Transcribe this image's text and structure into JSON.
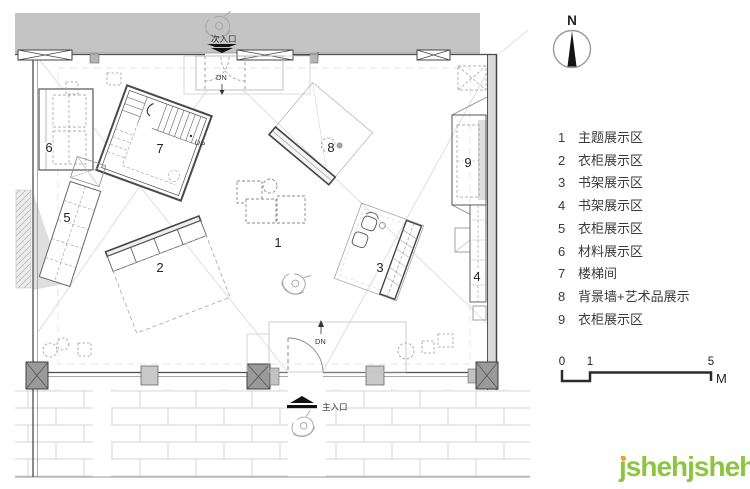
{
  "plan": {
    "zone_numbers": [
      "1",
      "2",
      "3",
      "4",
      "5",
      "6",
      "7",
      "8",
      "9"
    ],
    "labels": {
      "secondary_entrance": "次入口",
      "main_entrance": "主入口",
      "down_top": "DN",
      "down_bottom": "DN",
      "up": "UP"
    }
  },
  "north_arrow": {
    "label": "N"
  },
  "legend": {
    "items": [
      {
        "num": "1",
        "label": "主题展示区"
      },
      {
        "num": "2",
        "label": "衣柜展示区"
      },
      {
        "num": "3",
        "label": "书架展示区"
      },
      {
        "num": "4",
        "label": "书架展示区"
      },
      {
        "num": "5",
        "label": "衣柜展示区"
      },
      {
        "num": "6",
        "label": "材料展示区"
      },
      {
        "num": "7",
        "label": "楼梯间"
      },
      {
        "num": "8",
        "label": "背景墙+艺术品展示"
      },
      {
        "num": "9",
        "label": "衣柜展示区"
      }
    ]
  },
  "scale_bar": {
    "tick0": "0",
    "tick1": "1",
    "tick2": "5",
    "unit": "M"
  },
  "logo": {
    "name": "jsheh",
    "cn": "冀设汇",
    "suffix": ".com"
  },
  "colors": {
    "band": "#c4c4c4",
    "wall": "#4d4d4d",
    "logo_green": "#8cc63e",
    "logo_orange": "#f7a11a"
  }
}
